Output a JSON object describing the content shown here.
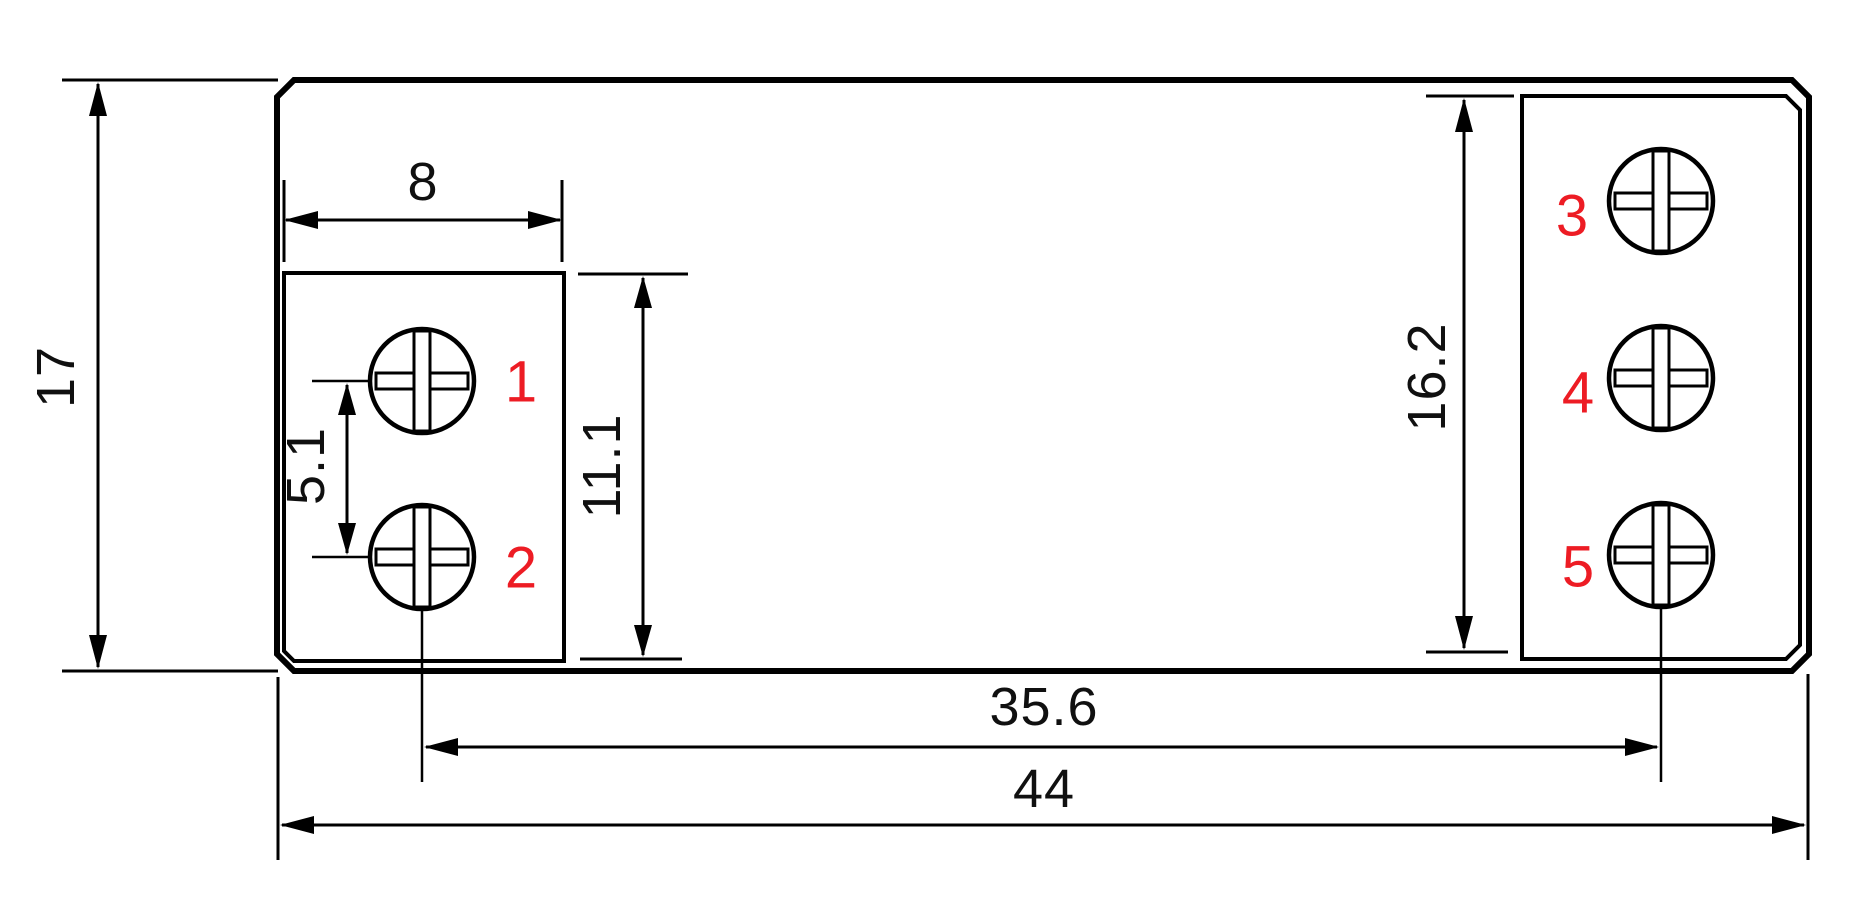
{
  "drawing": {
    "kind": "terminal-block-dimension-drawing",
    "dims": {
      "body_height": "17",
      "left_block_width": "8",
      "screw_pitch": "5.1",
      "left_block_height": "11.1",
      "right_block_height": "16.2",
      "terminal_span": "35.6",
      "body_width": "44"
    },
    "terminals": {
      "t1": "1",
      "t2": "2",
      "t3": "3",
      "t4": "4",
      "t5": "5"
    },
    "colors": {
      "line": "#000000",
      "terminal_label": "#ed1c24",
      "background": "#ffffff"
    }
  }
}
